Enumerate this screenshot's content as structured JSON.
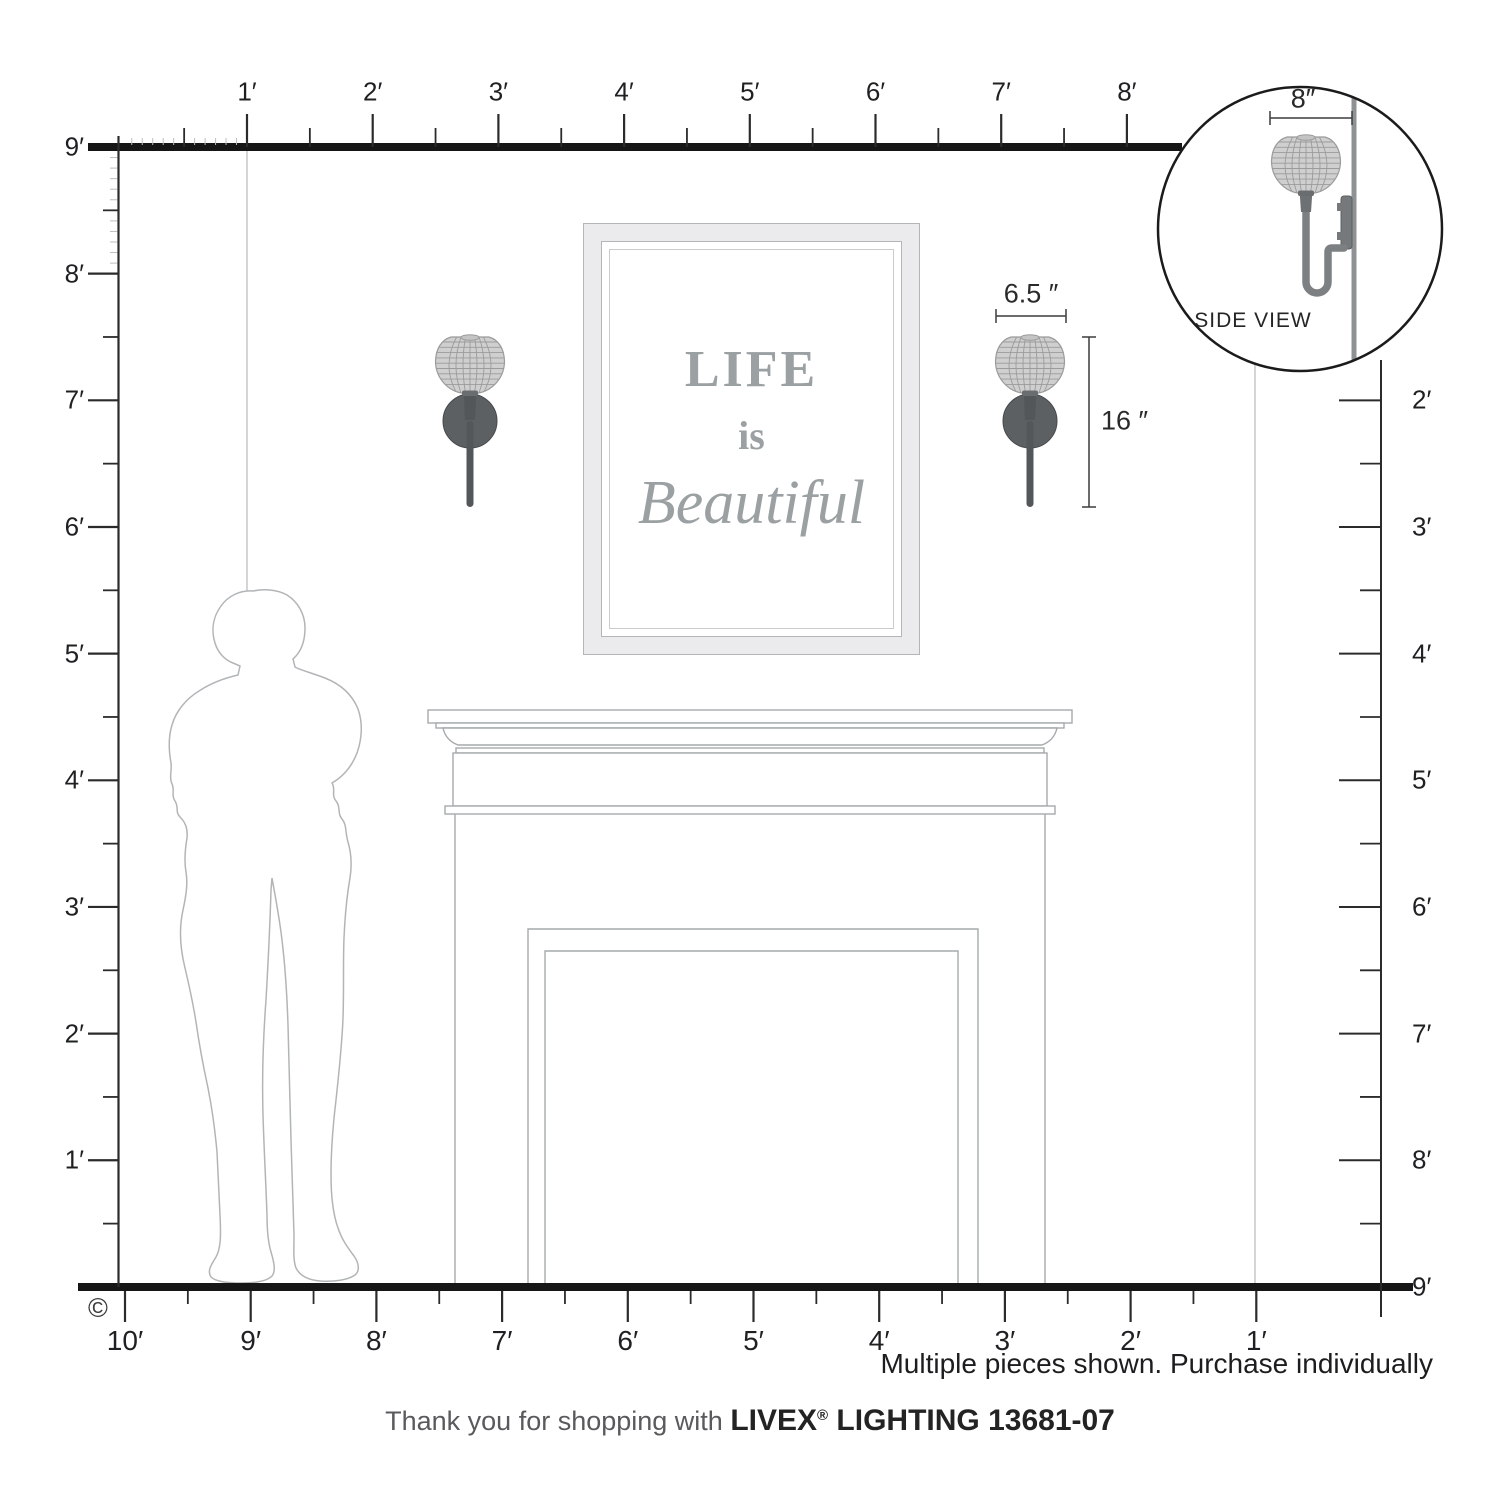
{
  "rulers": {
    "top": {
      "labels": [
        "1′",
        "2′",
        "3′",
        "4′",
        "5′",
        "6′",
        "7′",
        "8′"
      ]
    },
    "left": {
      "labels": [
        "9′",
        "8′",
        "7′",
        "6′",
        "5′",
        "4′",
        "3′",
        "2′",
        "1′"
      ]
    },
    "bottom": {
      "labels": [
        "10′",
        "9′",
        "8′",
        "7′",
        "6′",
        "5′",
        "4′",
        "3′",
        "2′",
        "1′"
      ]
    },
    "right": {
      "labels": [
        "2′",
        "3′",
        "4′",
        "5′",
        "6′",
        "7′",
        "8′"
      ],
      "floor_label": "9′"
    }
  },
  "dimensions": {
    "shade_width": "6.5 ″",
    "fixture_height": "16 ″",
    "side_depth": "8″"
  },
  "inset": {
    "label": "SIDE VIEW"
  },
  "artwork": {
    "line1": "LIFE",
    "line2": "is",
    "line3": "Beautiful"
  },
  "notes": {
    "multiple": "Multiple pieces shown. Purchase individually",
    "copyright": "©"
  },
  "footer": {
    "prefix": "Thank you for shopping with ",
    "brand": "LIVEX",
    "reg": "®",
    "suffix": " LIGHTING 13681-07"
  },
  "colors": {
    "structure_dark": "#161616",
    "ruler": "#2b2b2b",
    "ruler_minor": "#bdbdbd",
    "wall_line": "#bcbec0",
    "fireplace_line": "#a6aaac",
    "silhouette_line": "#b2b5b7",
    "metal_dark": "#5d6063",
    "shade_fill": "#cfcfcf",
    "shade_rib": "#9b9b9b",
    "art_text": "#9ba0a2"
  }
}
